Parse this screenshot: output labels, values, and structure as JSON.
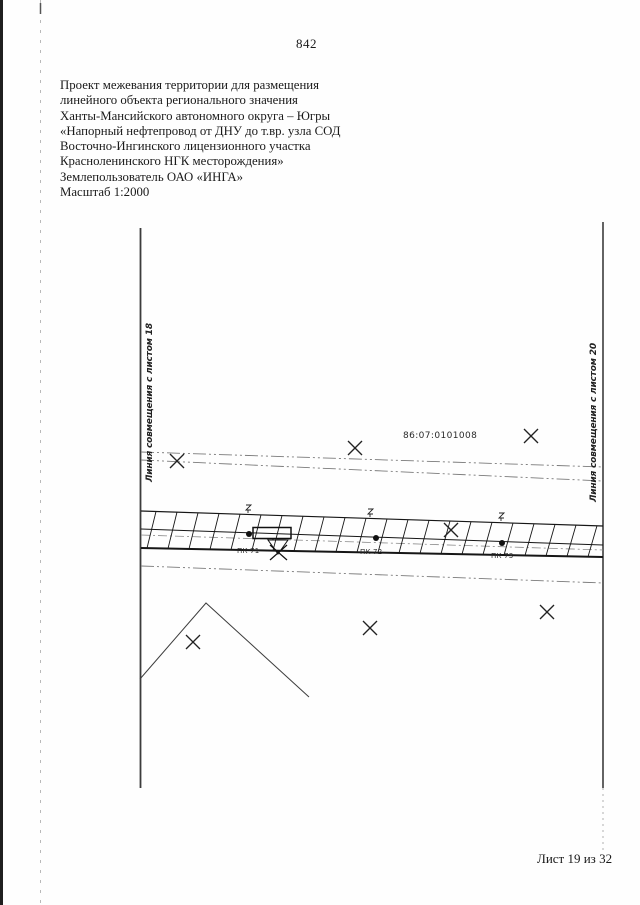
{
  "page": {
    "number": "842",
    "footer": "Лист 19 из 32"
  },
  "header": {
    "lines": [
      "Проект межевания территории для размещения",
      "линейного объекта регионального значения",
      "Ханты-Мансийского автономного округа – Югры",
      "«Напорный нефтепровод от ДНУ до т.вр. узла СОД",
      "Восточно-Ингинского лицензионного участка",
      "Красноленинского НГК месторождения»",
      "Землепользователь ОАО «ИНГА»",
      "Масштаб 1:2000"
    ]
  },
  "drawing": {
    "left_match_line_label": "Линия совмещения с листом 18",
    "right_match_line_label": "Линия совмещения с листом 20",
    "cadastral_quarter_number": "86:07:0101008",
    "pk_labels": [
      "ПК 71",
      "ПК 72",
      "ПК 73"
    ],
    "ink_color": "#1a1a1a"
  }
}
